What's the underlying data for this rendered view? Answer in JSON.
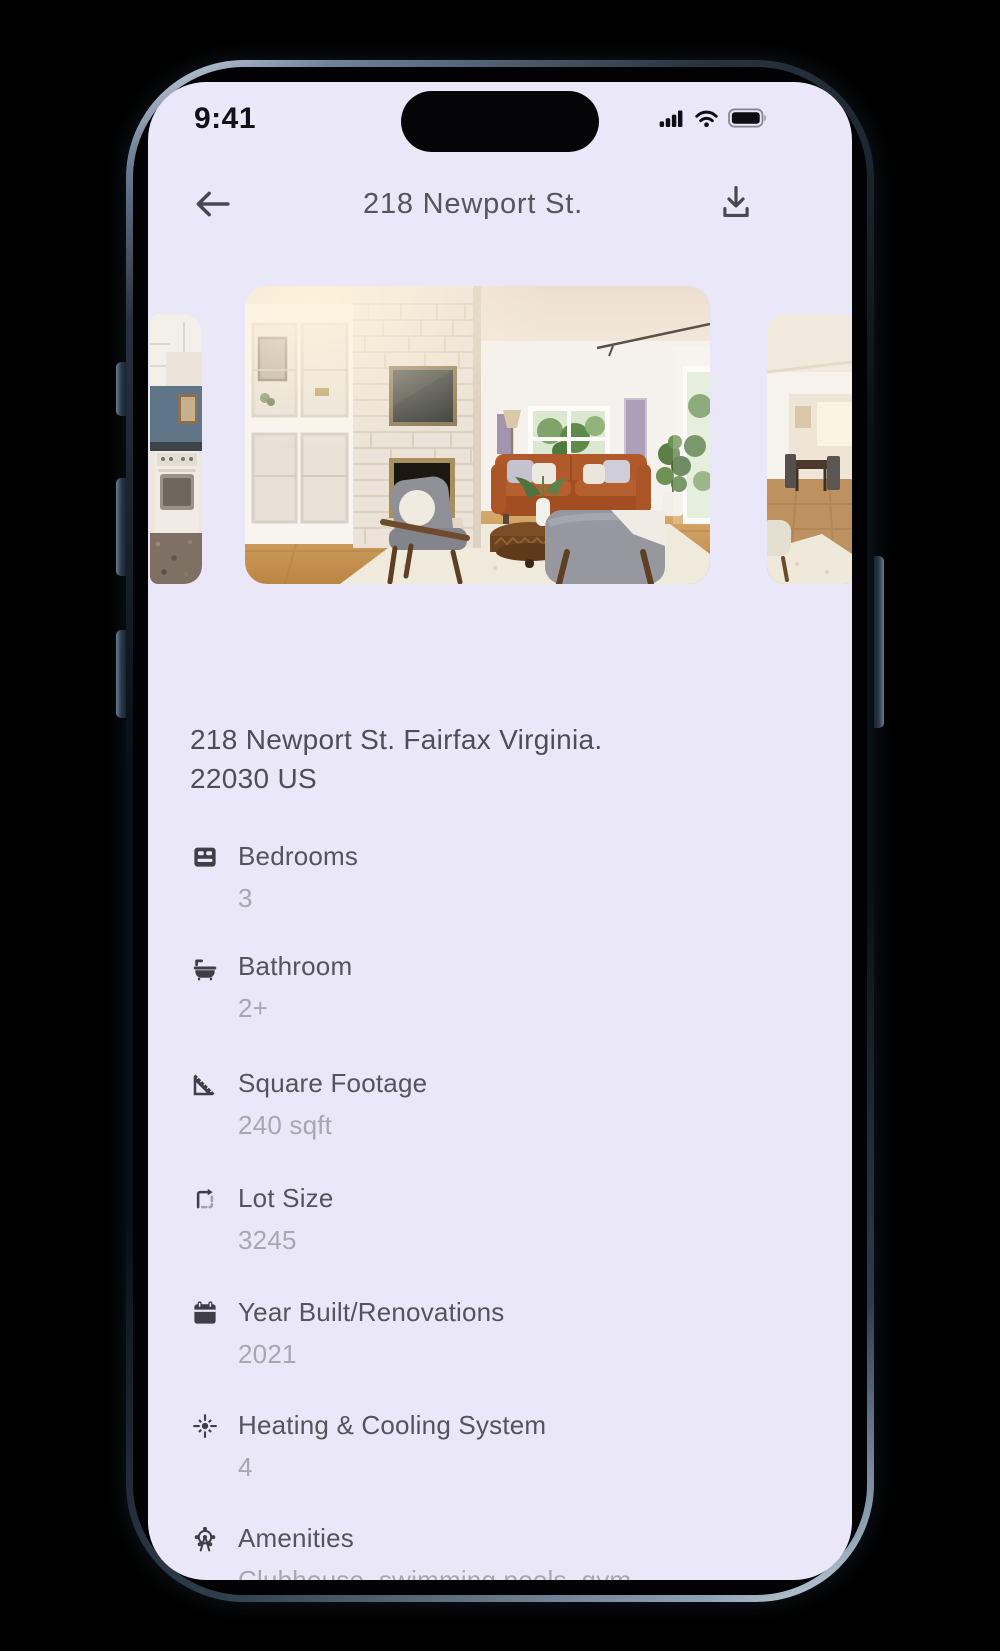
{
  "status_bar": {
    "time": "9:41"
  },
  "header": {
    "title": "218 Newport St."
  },
  "carousel": {
    "previous_label": "kitchen photo",
    "main_label": "living room photo",
    "next_label": "dining room photo"
  },
  "address": {
    "line1": "218 Newport St. Fairfax Virginia.",
    "line2": "22030 US"
  },
  "details": [
    {
      "icon": "bed-icon",
      "label": "Bedrooms",
      "value": "3"
    },
    {
      "icon": "bathtub-icon",
      "label": "Bathroom",
      "value": "2+"
    },
    {
      "icon": "square-foot-icon",
      "label": "Square Footage",
      "value": "240 sqft"
    },
    {
      "icon": "lot-size-icon",
      "label": "Lot Size",
      "value": "3245"
    },
    {
      "icon": "calendar-icon",
      "label": "Year Built/Renovations",
      "value": "2021"
    },
    {
      "icon": "sun-icon",
      "label": "Heating & Cooling System",
      "value": "4"
    },
    {
      "icon": "attractions-icon",
      "label": "Amenities",
      "value": "Clubhouse, swimming pools, gym"
    }
  ],
  "colors": {
    "screen_background": "#EAE7F8",
    "label_text": "#55535C",
    "value_text": "#A8A7B1",
    "address_text": "#4F4D56",
    "icon": "#3F3D46",
    "frame_accent": "#71839a"
  }
}
